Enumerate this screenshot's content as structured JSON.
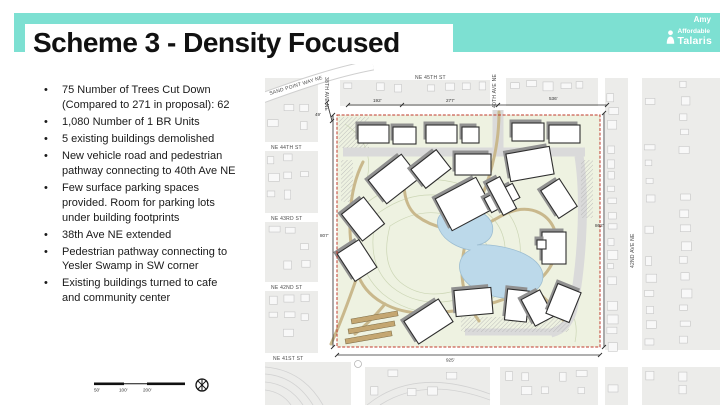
{
  "slide": {
    "title": "Scheme 3 - Density Focused",
    "presenter": "Amy",
    "logo": {
      "line1": "Affordable",
      "line2": "Talaris"
    }
  },
  "bullets": [
    "75 Number of Trees Cut Down (Compared to 271 in proposal): 62",
    "1,080 Number of 1 BR Units",
    "5 existing buildings demolished",
    "New vehicle road and pedestrian pathway connecting to 40th Ave NE",
    "Few surface parking spaces provided. Room for parking lots under building footprints",
    "38th Ave NE extended",
    "Pedestrian pathway connecting to Yesler Swamp in SW corner",
    "Existing buildings turned to cafe and community center"
  ],
  "scalebar": {
    "labels": [
      "50'",
      "100'",
      "200'"
    ]
  },
  "map": {
    "streets": {
      "sand_point": "SAND POINT WAY NE",
      "ne45": "NE 45TH ST",
      "ne44": "NE 44TH ST",
      "ne43": "NE 43RD ST",
      "ne42": "NE 42ND ST",
      "ne41": "NE 41ST ST",
      "ave38": "38TH AVE NE",
      "ave40": "40TH AVE NE",
      "ave42": "42ND AVE NE"
    },
    "dims": {
      "top_left": "192'",
      "top_mid": "277'",
      "top_right": "536'",
      "left": "807'",
      "right": "862'",
      "bottom": "925'",
      "jog": "49'"
    }
  },
  "colors": {
    "banner": "#7de0d2",
    "site_green": "#eef2e1",
    "pond_blue": "#bcd9ea",
    "path_tan": "#c9b88c",
    "boundary_red": "#c0392b"
  }
}
